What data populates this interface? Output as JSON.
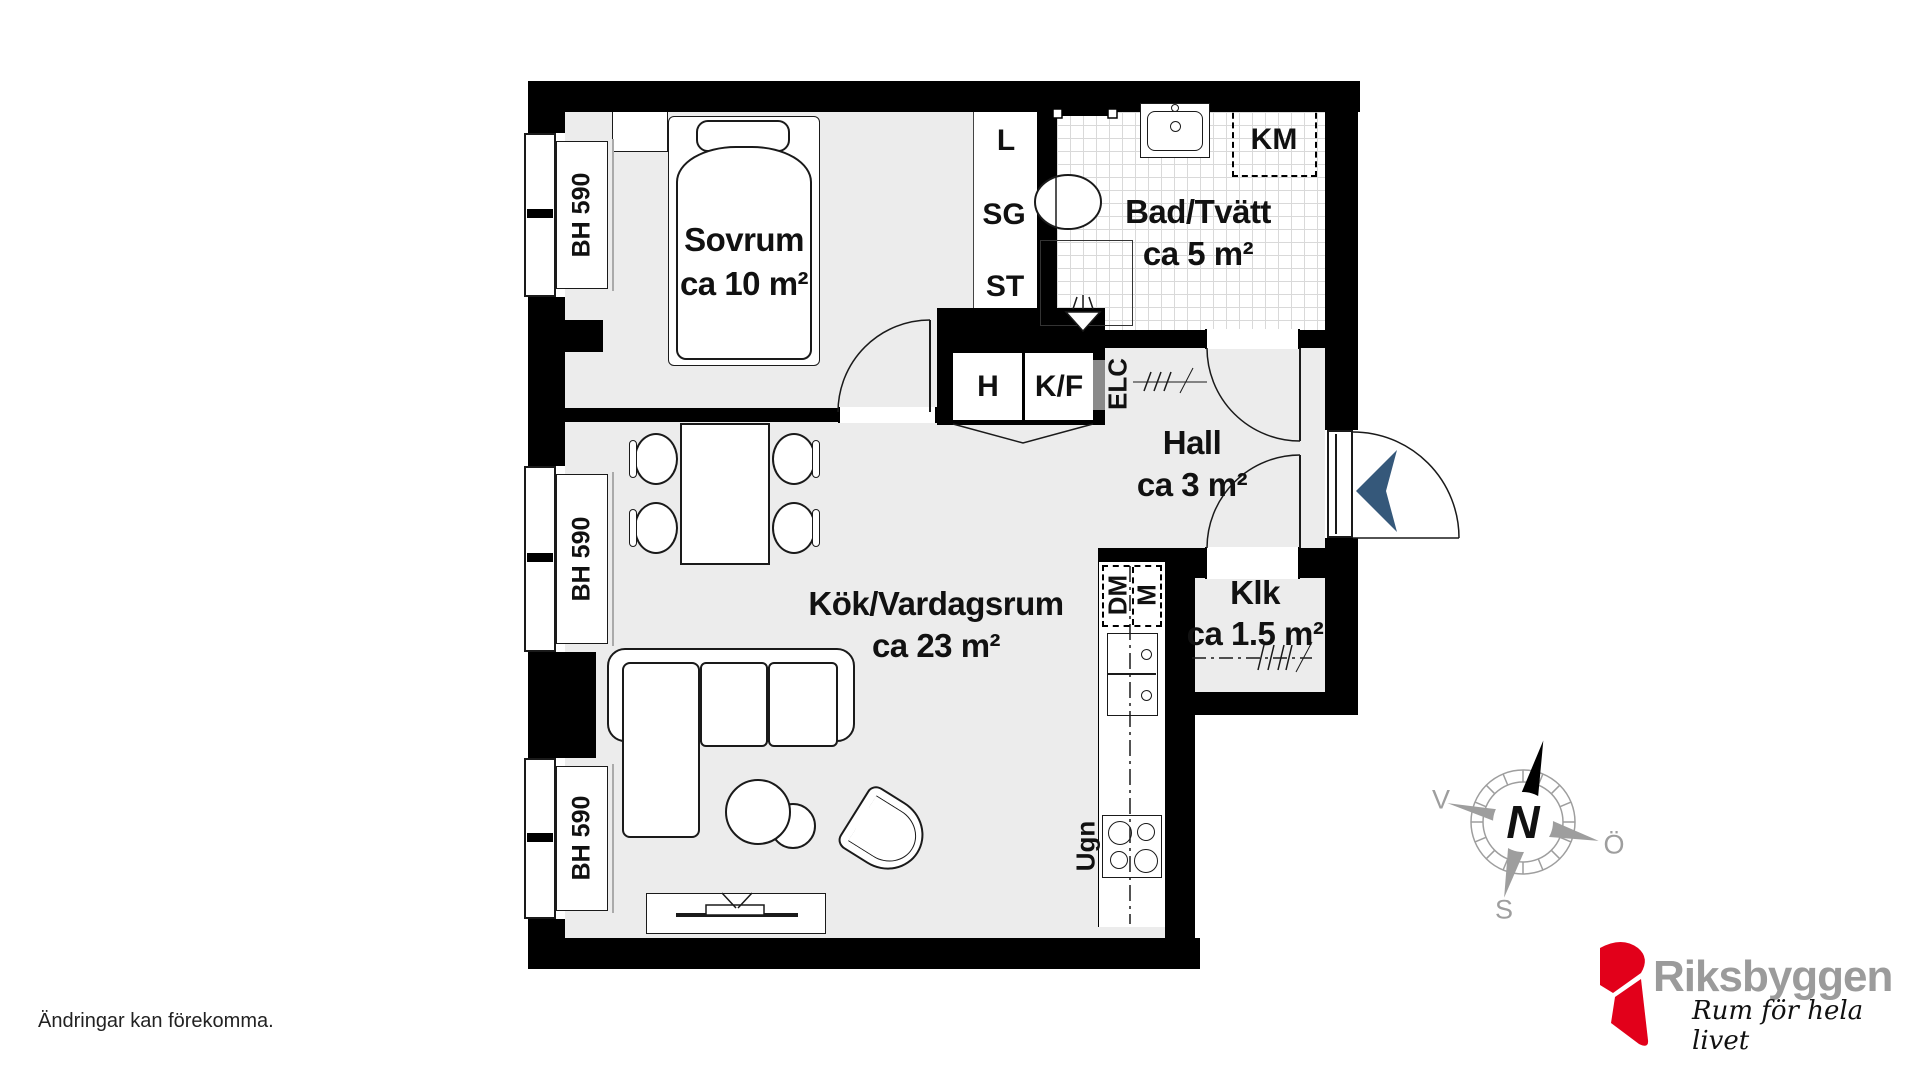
{
  "footer_note": "Ändringar kan förekomma.",
  "rooms": {
    "sovrum": {
      "name": "Sovrum",
      "area": "ca 10 m²"
    },
    "bad": {
      "name": "Bad/Tvätt",
      "area": "ca 5 m²"
    },
    "hall": {
      "name": "Hall",
      "area": "ca 3 m²"
    },
    "klk": {
      "name": "Klk",
      "area": "ca 1.5 m²"
    },
    "kok": {
      "name": "Kök/Vardagsrum",
      "area": "ca 23 m²"
    }
  },
  "fixtures": {
    "linen": "L",
    "sg": "SG",
    "st": "ST",
    "hall_closet": "H",
    "fridge_freezer": "K/F",
    "elc": "ELC",
    "washer": "KM",
    "dishwasher": "DM",
    "micro": "M",
    "oven": "Ugn"
  },
  "windows": {
    "label": "BH 590",
    "count": 3
  },
  "compass": {
    "north": "N",
    "west": "V",
    "east": "Ö",
    "south": "S"
  },
  "logo": {
    "brand": "Riksbyggen",
    "tagline": "Rum för hela livet"
  },
  "colors": {
    "wall": "#000000",
    "floor": "#ececec",
    "tile": "#d9d9d9",
    "entry_arrow": "#35587a",
    "brand_red": "#e2001a",
    "brand_gray": "#9b9b9b"
  }
}
